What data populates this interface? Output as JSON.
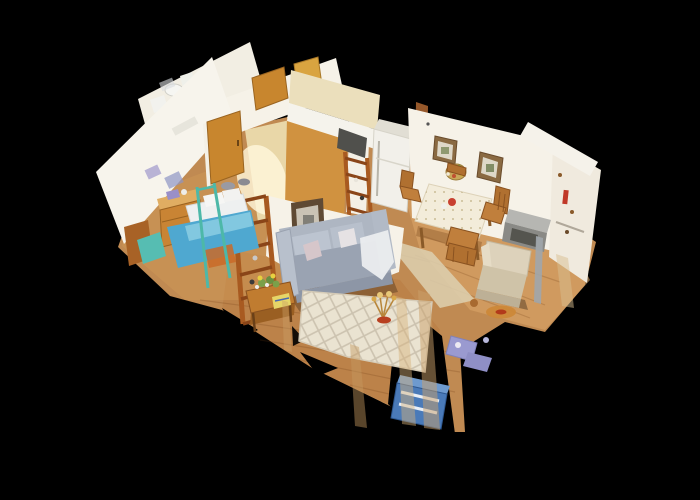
{
  "scene": {
    "type": "3d-dollhouse-scan-view",
    "description": "Top-down isometric dollhouse view of a scanned apartment on a black background",
    "background": "#000000",
    "rooms": [
      "bathroom",
      "hallway",
      "bedroom",
      "kitchen",
      "dining-room",
      "living-room"
    ],
    "palette": {
      "floorWood": "#c08a52",
      "floorWoodLight": "#dca76a",
      "floorWoodDark": "#b5723a",
      "hallTile": "#e9d7a8",
      "bathFloor": "#dfc99a",
      "wallWhite": "#f6f2e8",
      "wallBright": "#f7f4ec",
      "wallWarm": "#f0eade",
      "cabinetCream": "#ebdfbc",
      "counterWhite": "#f5f3ec",
      "doorOak": "#c8862e",
      "doorLight": "#d9a440",
      "tanWall": "#d09240",
      "postBrown": "#96582a",
      "fridgeWhite": "#f2f0ea",
      "sofaSeat": "#9aa3b2",
      "sofaBack": "#aeb6c2",
      "bedBlue": "#4fa8d0",
      "bedSheet": "#eef0f0",
      "tealAccent": "#4db8a8",
      "ladderWood": "#a85a20",
      "rugCream": "#eae3d1",
      "rugLine": "#c9bfac",
      "runnerBeige": "#ddd0b0",
      "armchairBeige": "#ddd2bb",
      "tableCloth": "#f3ecda",
      "chairWood": "#b07030",
      "orangeRug": "#cc8838",
      "blueBox": "#4a7ab8",
      "lavenderItem": "#9a9ad0",
      "metalGray": "#8a8a86",
      "redAccent": "#c23a34"
    }
  }
}
